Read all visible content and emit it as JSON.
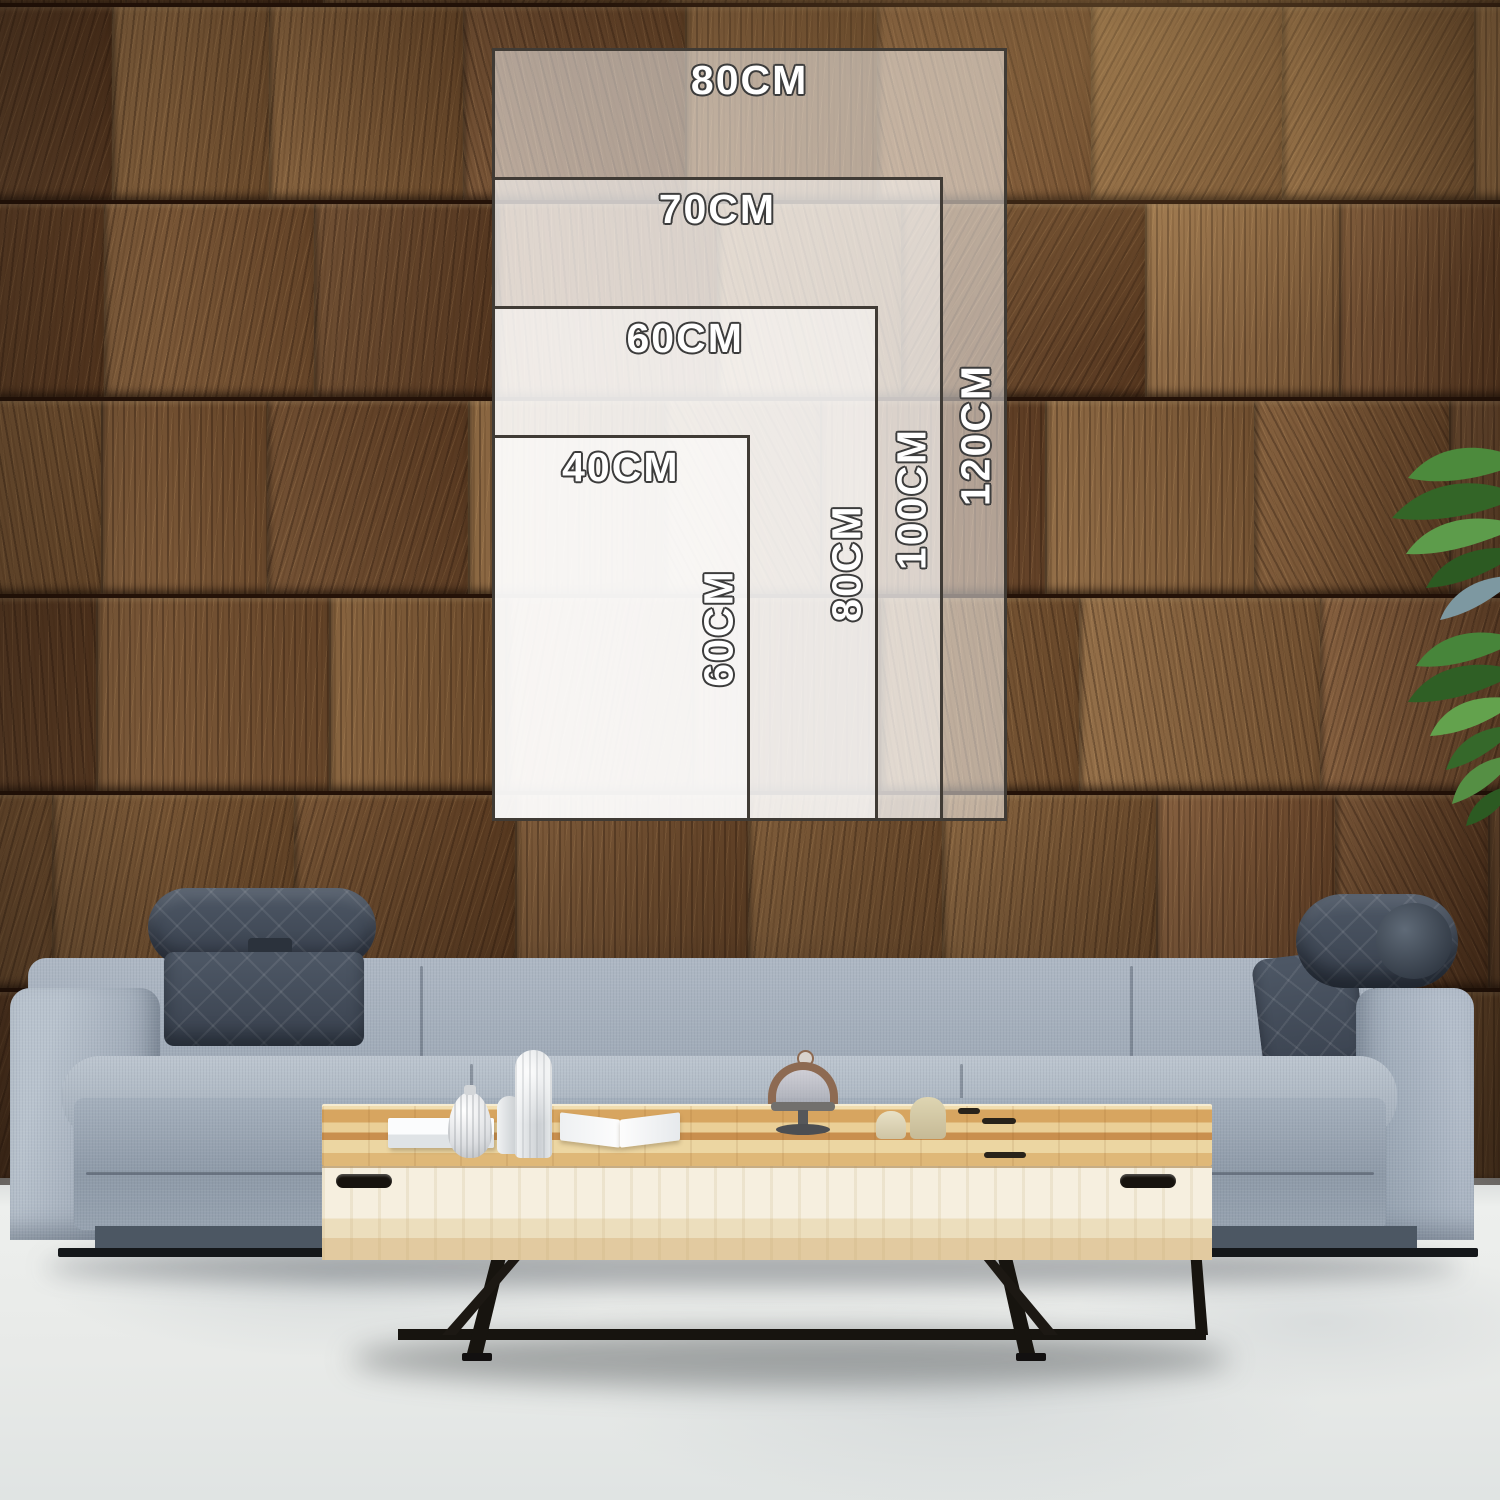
{
  "size_guide": {
    "unit_suffix": "CM",
    "options": [
      {
        "width_cm": 80,
        "height_cm": 120,
        "width_label": "80CM",
        "height_label": "120CM"
      },
      {
        "width_cm": 70,
        "height_cm": 100,
        "width_label": "70CM",
        "height_label": "100CM"
      },
      {
        "width_cm": 60,
        "height_cm": 80,
        "width_label": "60CM",
        "height_label": "80CM"
      },
      {
        "width_cm": 40,
        "height_cm": 60,
        "width_label": "40CM",
        "height_label": "60CM"
      }
    ]
  },
  "colors": {
    "overlay_fill": "rgba(255,255,255,0.5)",
    "overlay_border": "#403b35",
    "label_text": "#ffffff",
    "label_outline": "#3c3c3c",
    "wall_browns": [
      "#745030",
      "#6a462a",
      "#7e5a36",
      "#5d3d24",
      "#86613c",
      "#694628",
      "#7a5633",
      "#8a6540",
      "#634126",
      "#795233"
    ],
    "sofa_gray": "#a3aebb",
    "headrest_dark": "#454f5c",
    "table_wood": "#dcae6c",
    "table_front": "#f2ead8",
    "metal_leg": "#17140f",
    "floor": "#e8eae9",
    "plant_green": "#4a8338"
  }
}
